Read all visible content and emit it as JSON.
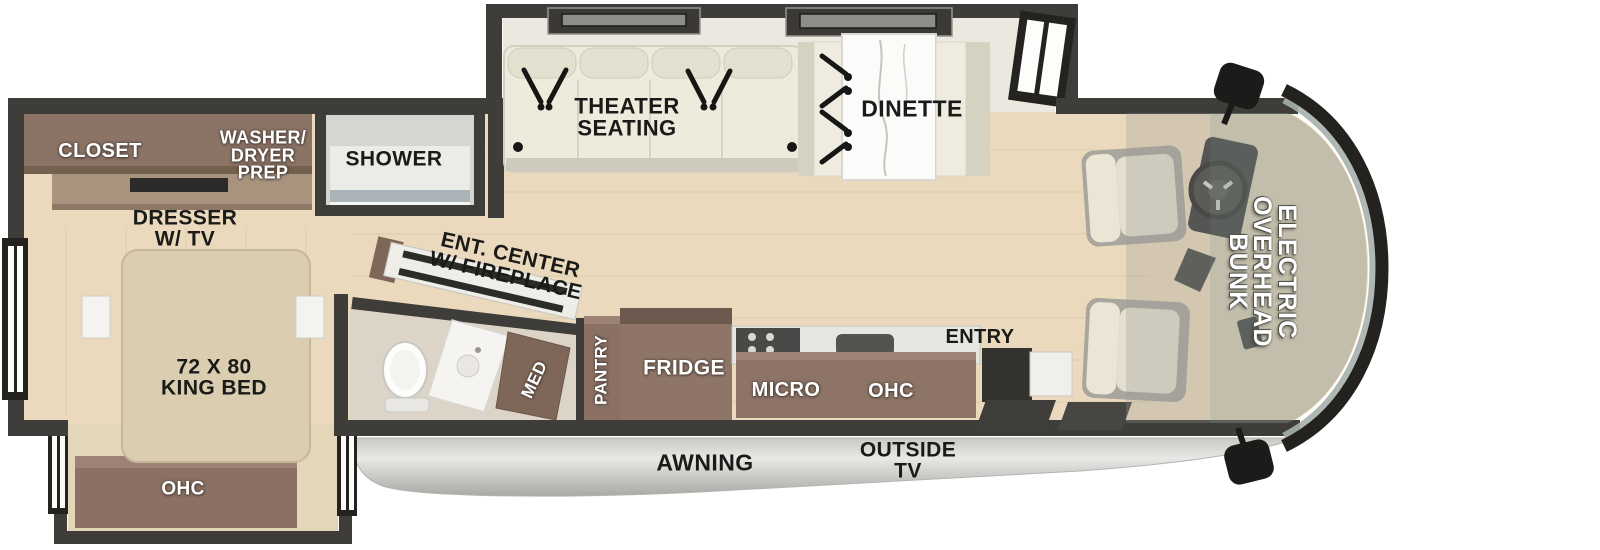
{
  "plan": {
    "bedroom": {
      "closet": "CLOSET",
      "washer_dryer_prep": "WASHER/\nDRYER\nPREP",
      "dresser": "DRESSER\nW/ TV",
      "bed": "72 X 80\nKING BED",
      "ohc": "OHC"
    },
    "bath": {
      "shower": "SHOWER",
      "med": "MED"
    },
    "living": {
      "theater_seating": "THEATER\nSEATING",
      "dinette": "DINETTE",
      "ent_center": "ENT. CENTER\nW/ FIREPLACE"
    },
    "kitchen": {
      "pantry": "PANTRY",
      "fridge": "FRIDGE",
      "micro": "MICRO",
      "ohc": "OHC",
      "entry": "ENTRY"
    },
    "exterior": {
      "awning": "AWNING",
      "outside_tv": "OUTSIDE\nTV"
    },
    "cab": {
      "overhead_bunk": "ELECTRIC\nOVERHEAD\nBUNK"
    },
    "colors": {
      "wall": "#3e3d3a",
      "floor_wood": "#ead9bc",
      "cabinet_brown": "#8b7366",
      "sofa_cream": "#efecdf",
      "awning_silver": "#d3d2cf",
      "bunk_shade": "#8a9692",
      "label_black": "#1a1a18",
      "label_white": "#ffffff"
    }
  }
}
